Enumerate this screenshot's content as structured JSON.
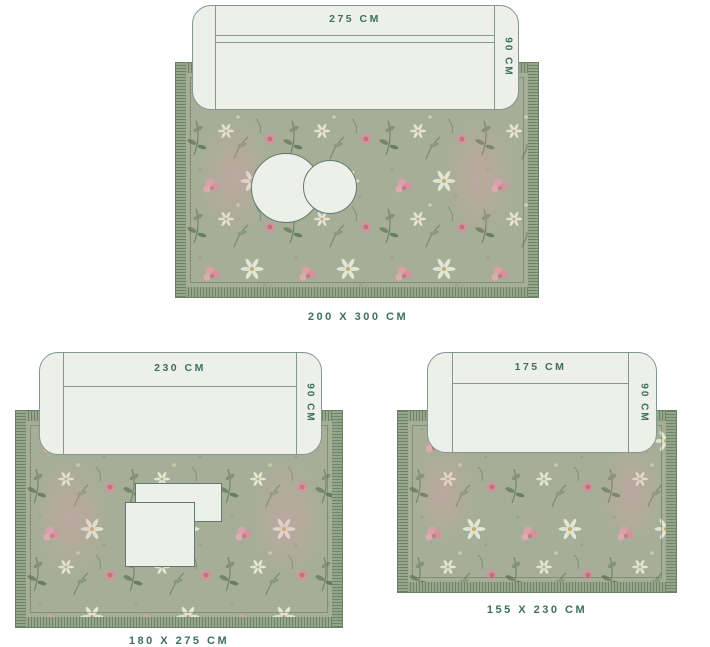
{
  "colors": {
    "accent_text": "#3d6e62",
    "sofa_fill": "#edf0e8",
    "sofa_outline": "#829792",
    "rug_base": "#a6ae97",
    "rug_fringe_dark": "#6e8367",
    "rug_fringe_light": "#96a68b",
    "flower_pink": "#dfa0ab",
    "flower_white": "#e9ecdf",
    "foliage_green": "#6d8261",
    "background": "#ffffff"
  },
  "diagrams": [
    {
      "name": "rug-200x300",
      "rug_label": "200 X 300 CM",
      "sofa_width_label": "275 CM",
      "sofa_depth_label": "90 CM",
      "tables": "two overlapping round coffee tables"
    },
    {
      "name": "rug-180x275",
      "rug_label": "180 X 275 CM",
      "sofa_width_label": "230 CM",
      "sofa_depth_label": "90 CM",
      "tables": "two overlapping rectangular coffee tables"
    },
    {
      "name": "rug-155x230",
      "rug_label": "155 X 230 CM",
      "sofa_width_label": "175 CM",
      "sofa_depth_label": "90 CM",
      "tables": "none"
    }
  ]
}
